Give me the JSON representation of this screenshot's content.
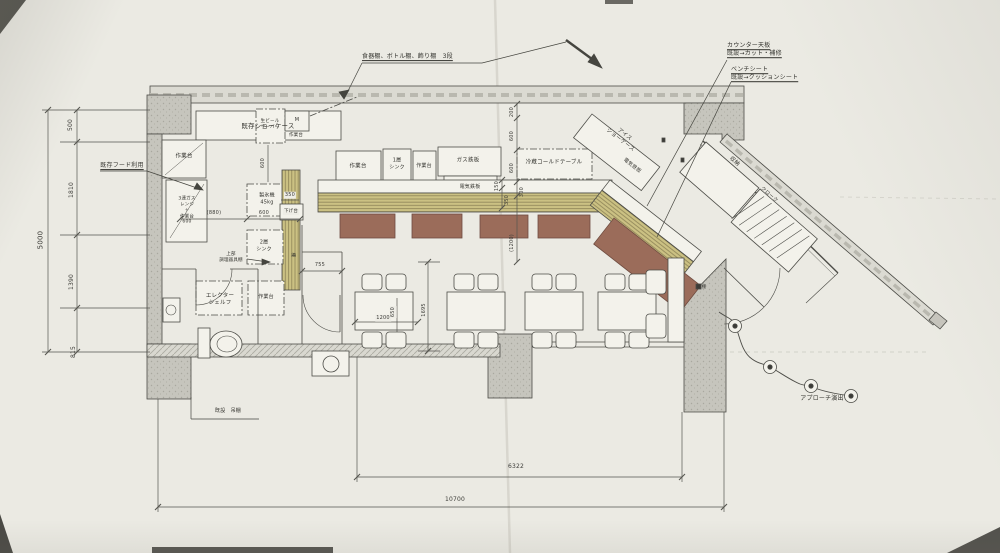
{
  "colors": {
    "paper": "#ebeae3",
    "line": "#4c4c47",
    "counter_wood": "#cbc183",
    "bench_brown": "#9b6c5a",
    "wall_gray": "#c6c5bd"
  },
  "annotations": {
    "top_shelf_note": "食器棚、ボトル棚、飾り棚　3段",
    "counter_note": "カウンター天板\n既設→カット・補修",
    "bench_note": "ベンチシート\n既設→クッションシート",
    "hood_note": "既存フード利用",
    "approach_note": "アプローチ演出"
  },
  "fixtures": {
    "showcase": "既存ショーケース",
    "beer_server": "生ビール\nサーバー",
    "beer_server_mark": "M",
    "worktable": "作業台",
    "gas_range": "3連ガス\nレンジ\n＋\n作業台\n600",
    "ice_maker": "製氷機\n45kg",
    "lowering_table": "下げ台",
    "sink_2": "2層\nシンク",
    "sink_1": "1層\nシンク",
    "upper_shelf": "上部\n調理器具棚",
    "erecta_shelf": "エレクター\nシェルフ",
    "gas_teppan": "ガス鉄板",
    "electric_teppan": "電気鉄板",
    "cold_table": "冷蔵コールドテーブル",
    "ice_showcase": "アイス\nショーケース",
    "storage": "収納",
    "cloak": "クローク",
    "shelf": "棚",
    "hanging_shelf": "既設　吊棚"
  },
  "dimensions": {
    "d5000": "5000",
    "d500": "500",
    "d1810": "1810",
    "d1390": "1390",
    "d815": "815",
    "d880": "(880)",
    "d600": "600",
    "d350": "350",
    "d200": "200",
    "d150": "150",
    "d300": "300",
    "d1200p": "(1200)",
    "d755": "755",
    "d1200": "1200",
    "d650": "650",
    "d1695": "1695",
    "d6322": "6322",
    "d10700": "10700"
  }
}
